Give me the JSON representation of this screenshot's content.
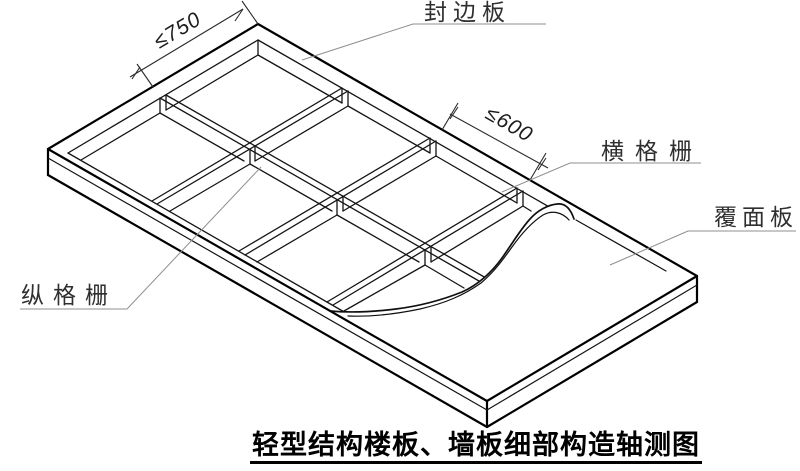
{
  "app": {
    "background": "#ffffff",
    "ink": "#000000",
    "frame_line_color": "#141414",
    "leader_color": "#8f8f8f",
    "dim_color": "#2a2a2a"
  },
  "labels": {
    "edge_board": "封边板",
    "transverse_joist": "横格栅",
    "cover_panel": "覆面板",
    "longitudinal_joist": "纵格栅"
  },
  "dimensions": {
    "cell_width": "≤750",
    "joist_spacing": "≤600"
  },
  "title": {
    "text": "轻型结构楼板、墙板细部构造轴测图"
  }
}
